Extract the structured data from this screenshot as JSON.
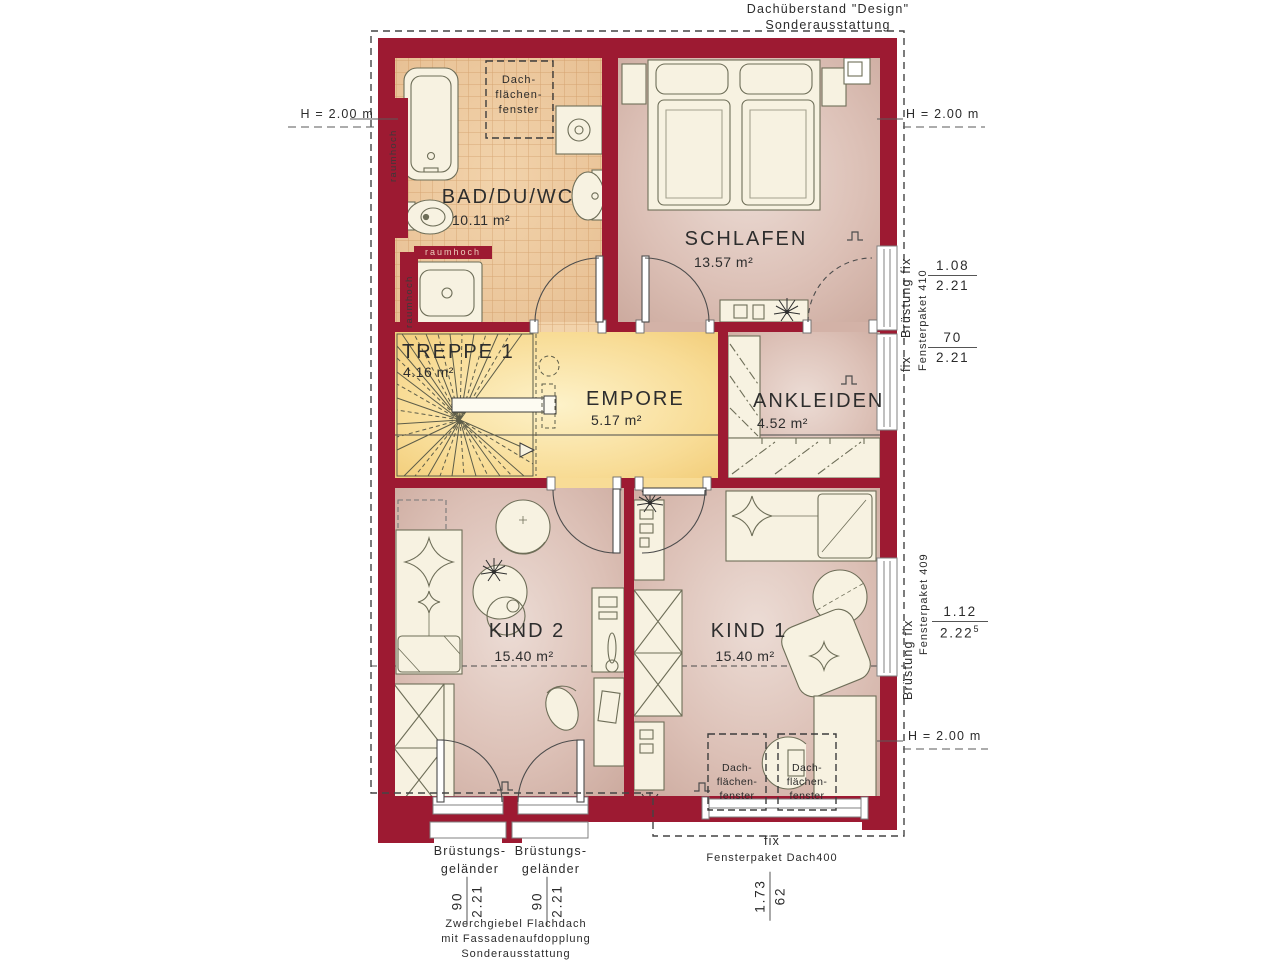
{
  "colors": {
    "wall": "#9d1a32",
    "tile": "#f2d3ab",
    "floor": "#d9bcb1",
    "landing": "#f8dc96"
  },
  "header": {
    "roof_note_line1": "Dachüberstand \"Design\"",
    "roof_note_line2": "Sonderausstattung"
  },
  "height_marks": {
    "left": "H = 2.00 m",
    "right_top": "H = 2.00 m",
    "right_bottom": "H = 2.00 m"
  },
  "rooms": [
    {
      "name": "BAD/DU/WC",
      "area": "10.11 m²"
    },
    {
      "name": "SCHLAFEN",
      "area": "13.57 m²"
    },
    {
      "name": "TREPPE 1",
      "area": "4.16 m²"
    },
    {
      "name": "EMPORE",
      "area": "5.17 m²"
    },
    {
      "name": "ANKLEIDEN",
      "area": "4.52 m²"
    },
    {
      "name": "KIND 2",
      "area": "15.40 m²"
    },
    {
      "name": "KIND 1",
      "area": "15.40 m²"
    }
  ],
  "skylight": {
    "line1": "Dach-",
    "line2": "flächen-",
    "line3": "fenster"
  },
  "wall_labels": {
    "raumhoch": "raumhoch"
  },
  "right_annotations": {
    "upper": {
      "rot_main": "Brüstung fix",
      "rot_fix": "fix",
      "package": "Fensterpaket 410",
      "frac1": {
        "num": "1.08",
        "den": "2.21"
      },
      "frac2": {
        "num": "70",
        "den": "2.21"
      }
    },
    "lower": {
      "rot_main": "Brüstung fix",
      "package": "Fensterpaket 409",
      "frac": {
        "num": "1.12",
        "den": "2.22",
        "sup": "5"
      }
    }
  },
  "bottom_annotations": {
    "balcony_label_line1": "Brüstungs-",
    "balcony_label_line2": "geländer",
    "balcony_frac": {
      "num": "90",
      "den": "2.21"
    },
    "fix_label": "fix",
    "package": "Fensterpaket Dach400",
    "roof_window_frac": {
      "num": "1.73",
      "den": "62"
    },
    "note_line1": "Zwerchgiebel Flachdach",
    "note_line2": "mit Fassadenaufdopplung",
    "note_line3": "Sonderausstattung"
  }
}
